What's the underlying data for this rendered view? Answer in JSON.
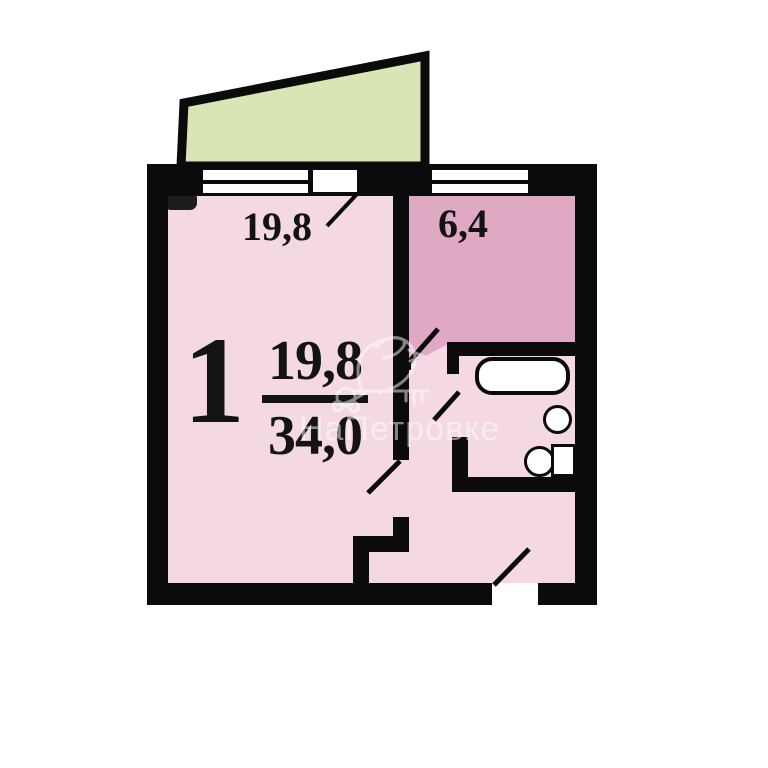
{
  "plan_title": "one-room-apartment-floor-plan",
  "colors": {
    "wall": "#0b0b0b",
    "room-pink": "#f4d9e4",
    "kitchen-pink": "#dfa9c4",
    "balcony-green": "#d7e6b4",
    "fixture-white": "#ffffff",
    "label": "#131313"
  },
  "labels": {
    "rooms_count": "1",
    "living_area": "19,8",
    "total_area": "34,0",
    "room_area": "19,8",
    "kitchen_area": "6,4"
  },
  "watermark": {
    "text": "НаПетровке"
  }
}
